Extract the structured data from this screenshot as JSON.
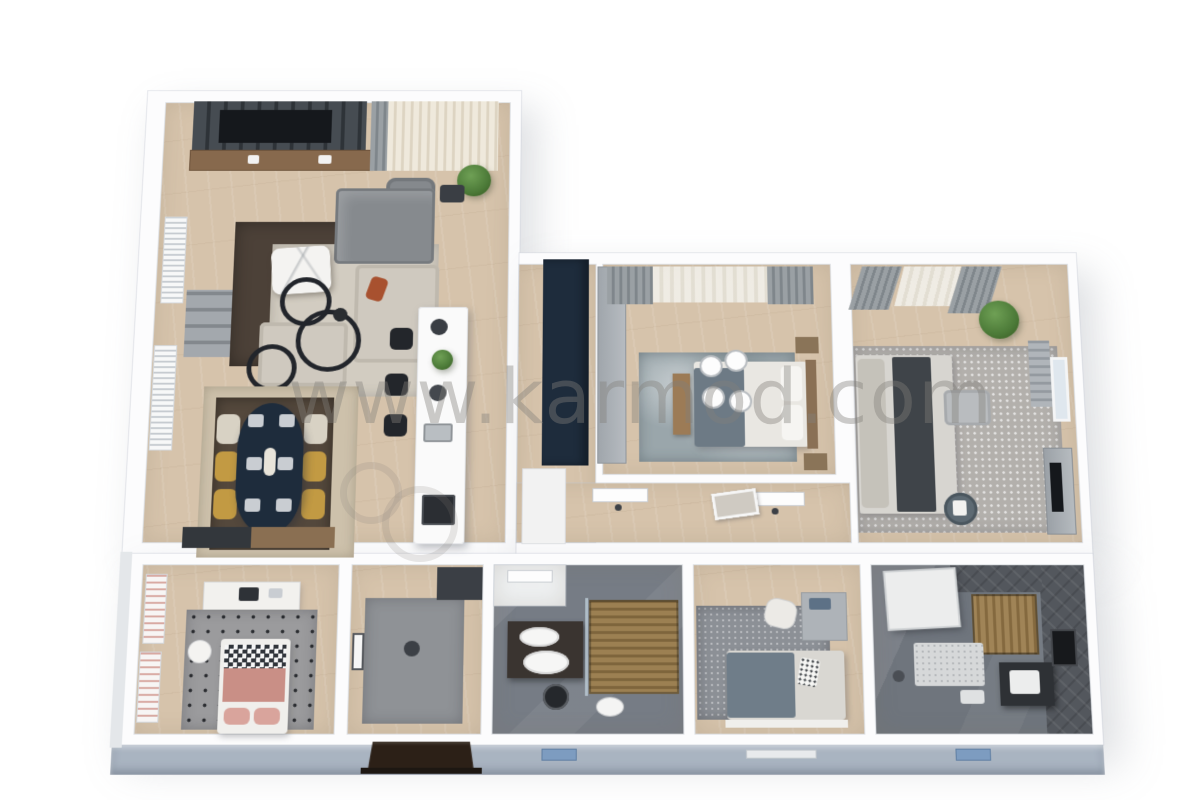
{
  "watermark": {
    "text": "www.karmod.com"
  },
  "palette": {
    "wall": "#fcfcfd",
    "wood": "#d6c3ab",
    "facade": "#a9b4c1",
    "navy": "#1e2c3c",
    "mustard": "#c29a43",
    "cream": "#d8d2c4",
    "sofa-gray": "#868a8e",
    "sofa-light": "#cfc9bf",
    "rug-brown": "#4c4138",
    "rug-light": "#d2ccc1",
    "rug-marble": "#9aa6ab",
    "rug-b2": "#b3b0ac",
    "rug-kid": "#9b9b9d",
    "rug-entry": "#8f9296",
    "rug-b3": "#8c9096",
    "bath-floor": "#767c85",
    "bath-floor2": "#6f757d",
    "door-dark": "#2c2017",
    "window-blue": "#7d9cc0",
    "green": "#4c7a38",
    "tv": "#15181c",
    "wm": "rgba(130,127,122,0.40)"
  },
  "scene": {
    "type": "3d-rendered-floor-plan",
    "view": "isometric top-down",
    "rooms": [
      {
        "name": "living-room",
        "furniture": [
          "tv-media-wall",
          "wood-console",
          "sheer-curtains",
          "potted-plant",
          "armchair",
          "chaise-sofa",
          "sectional-sofa",
          "marble-coffee-table",
          "dark-area-rug",
          "light-area-rug",
          "decor-rings",
          "window-shutters",
          "wall-shelf",
          "floor-lamp"
        ]
      },
      {
        "name": "dining-area",
        "furniture": [
          "oval-dining-table-navy",
          "cream-chairs",
          "mustard-chairs",
          "place-settings",
          "sideboard",
          "layered-rugs"
        ]
      },
      {
        "name": "kitchen",
        "furniture": [
          "white-island",
          "bar-stools",
          "cooktop",
          "sink",
          "tall-navy-cabinet",
          "white-counter"
        ]
      },
      {
        "name": "hallway",
        "furniture": [
          "door-leafs",
          "wall-art-frame",
          "gray-wardrobe"
        ]
      },
      {
        "name": "bedroom-1",
        "furniture": [
          "double-bed",
          "gray-throw",
          "wood-bench",
          "nightstands",
          "ceiling-lights",
          "marble-rug",
          "curtains"
        ]
      },
      {
        "name": "bedroom-2",
        "furniture": [
          "double-bed",
          "dark-runner",
          "ottoman",
          "round-side-table",
          "dresser-with-tv",
          "textured-rug",
          "potted-plant",
          "curtains",
          "window-shutters"
        ]
      },
      {
        "name": "kids-bedroom",
        "furniture": [
          "single-bed",
          "checkered-blanket",
          "pink-blanket",
          "polka-dot-rug",
          "desk",
          "desk-chair",
          "white-pouf",
          "pink-striped-blinds"
        ]
      },
      {
        "name": "entry-room",
        "furniture": [
          "gray-rug",
          "dark-wardrobe",
          "wall-frame"
        ]
      },
      {
        "name": "bathroom-1",
        "furniture": [
          "vestibule-door",
          "double-sink-vanity",
          "round-mirror",
          "toilet",
          "wood-slat-shower"
        ]
      },
      {
        "name": "bedroom-3",
        "furniture": [
          "bed",
          "blue-gray-blanket",
          "patterned-pillow",
          "barrel-chair",
          "dresser",
          "textured-rug"
        ]
      },
      {
        "name": "bathroom-2",
        "furniture": [
          "shower-tray",
          "wood-slat-sauna",
          "bath-mat",
          "dark-vanity-sink",
          "wall-mirror",
          "dark-tile-wall"
        ]
      }
    ],
    "exterior": {
      "features": [
        "front-facade",
        "entrance-door-with-steps",
        "facade-window-blue-left",
        "facade-window-sill-center",
        "facade-window-blue-right"
      ]
    }
  }
}
